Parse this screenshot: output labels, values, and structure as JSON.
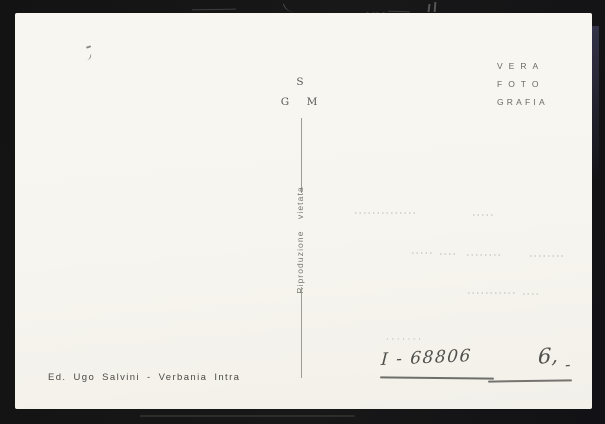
{
  "colors": {
    "scanner_background": "#141414",
    "card": "#f7f5f0",
    "print_gray": "#6d6a63",
    "print_dark": "#4a4a47",
    "pencil": "#50504d",
    "divider": "#9c9c95"
  },
  "monogram": {
    "top": "S",
    "left": "G",
    "right": "M"
  },
  "photographer_mark": {
    "line1": "VERA",
    "line2": "FOTO",
    "line3": "GRAFIA"
  },
  "reproduction_notice": "Riproduzione vietata",
  "publisher_line": "Ed. Ugo Salvini - Verbania Intra",
  "handwriting": {
    "dots": "·······",
    "catalog_number": "I - 68806",
    "price": "6,",
    "price_dash": "-"
  }
}
